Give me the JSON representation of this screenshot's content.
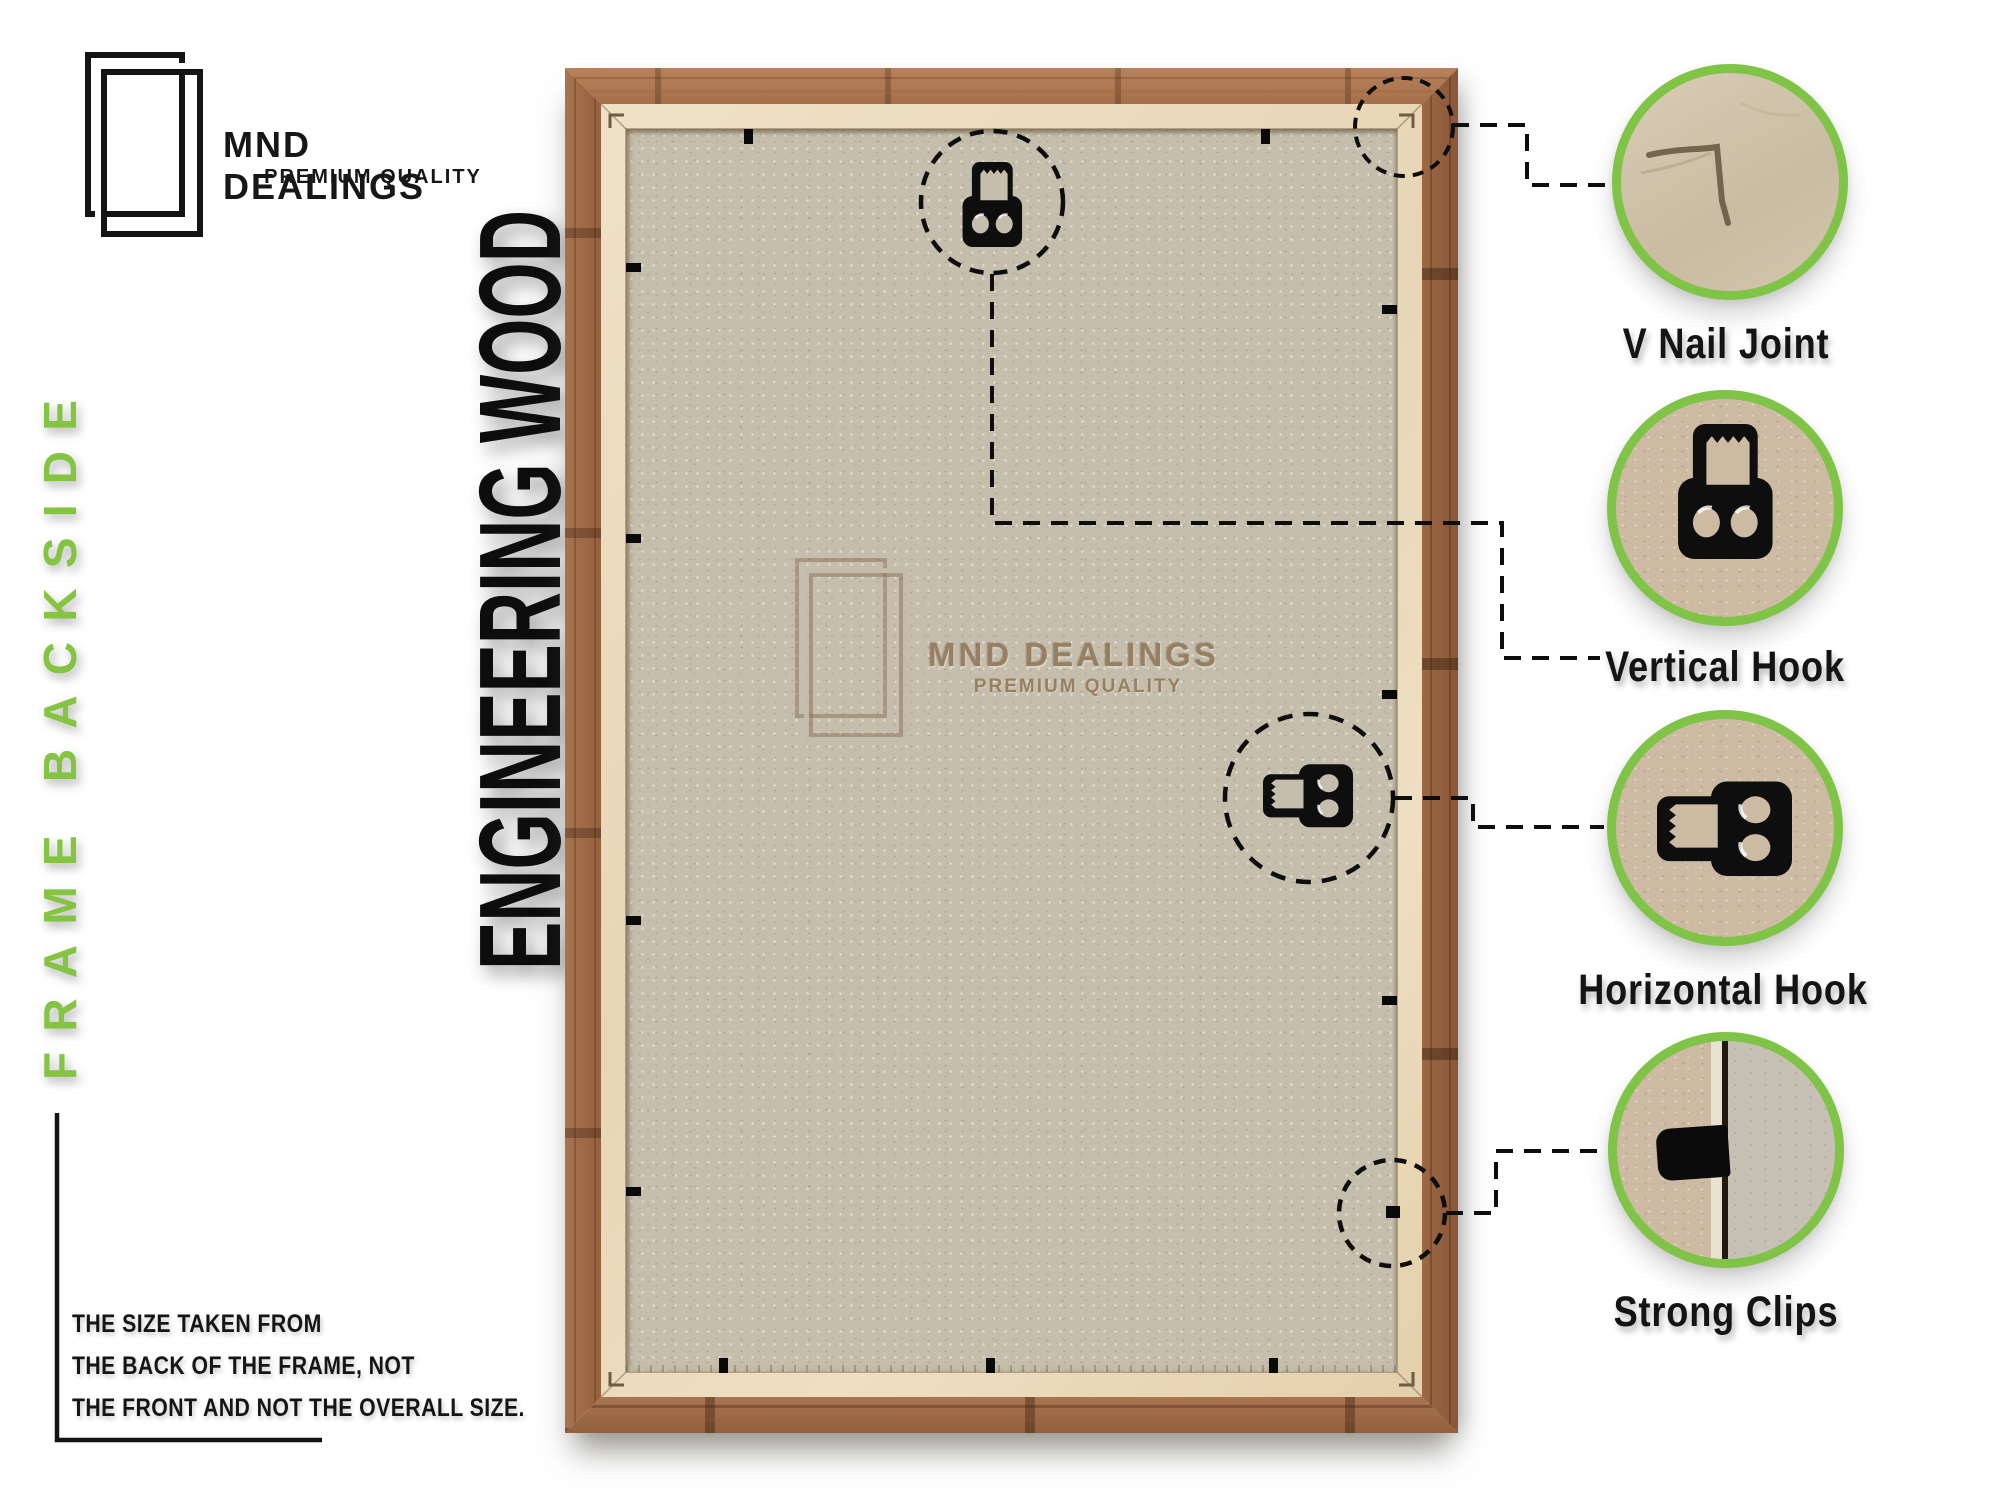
{
  "brand": {
    "name": "MND DEALINGS",
    "tagline": "PREMIUM QUALITY"
  },
  "side": {
    "frame_side_label": "FRAME BACKSIDE",
    "material_label": "ENGINEERING WOOD"
  },
  "watermark": {
    "name": "MND DEALINGS",
    "tagline": "PREMIUM QUALITY"
  },
  "callouts": {
    "v_nail_joint": "V Nail Joint",
    "vertical_hook": "Vertical Hook",
    "horizontal_hook": "Horizontal Hook",
    "strong_clips": "Strong Clips"
  },
  "note": {
    "line1": "THE SIZE TAKEN FROM",
    "line2": "THE BACK OF THE FRAME, NOT",
    "line3": "THE FRONT AND NOT THE OVERALL SIZE."
  },
  "colors": {
    "accent_green": "#7fc347",
    "text_green": "#84c440",
    "wood_brown": "#a9714e",
    "mdf_cream": "#ead9bd",
    "backing_gray": "#c4bcab",
    "ink_black": "#141414"
  }
}
